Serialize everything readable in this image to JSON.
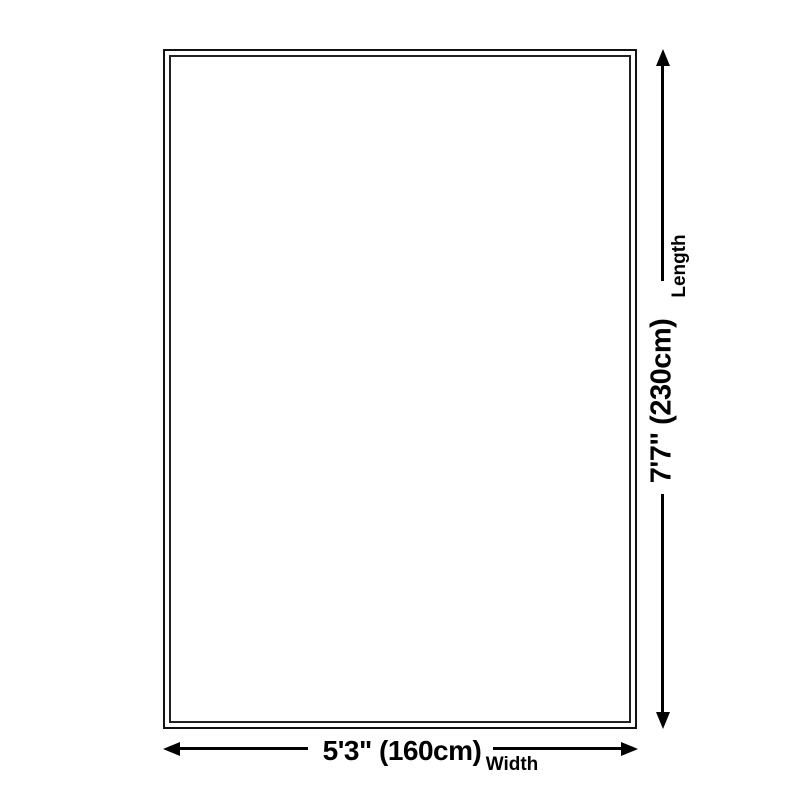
{
  "page": {
    "background_color": "#ffffff",
    "line_color": "#000000",
    "outline_border_color": "#121212"
  },
  "diagram": {
    "product_shape": "rectangle",
    "length": {
      "label": "Length",
      "value": "7'7\" (230cm)"
    },
    "width": {
      "label": "Width",
      "value": "5'3\" (160cm)"
    },
    "icons": {
      "vertical_dimension": "vertical-double-headed-arrow-icon",
      "horizontal_dimension": "horizontal-double-headed-arrow-icon"
    }
  }
}
